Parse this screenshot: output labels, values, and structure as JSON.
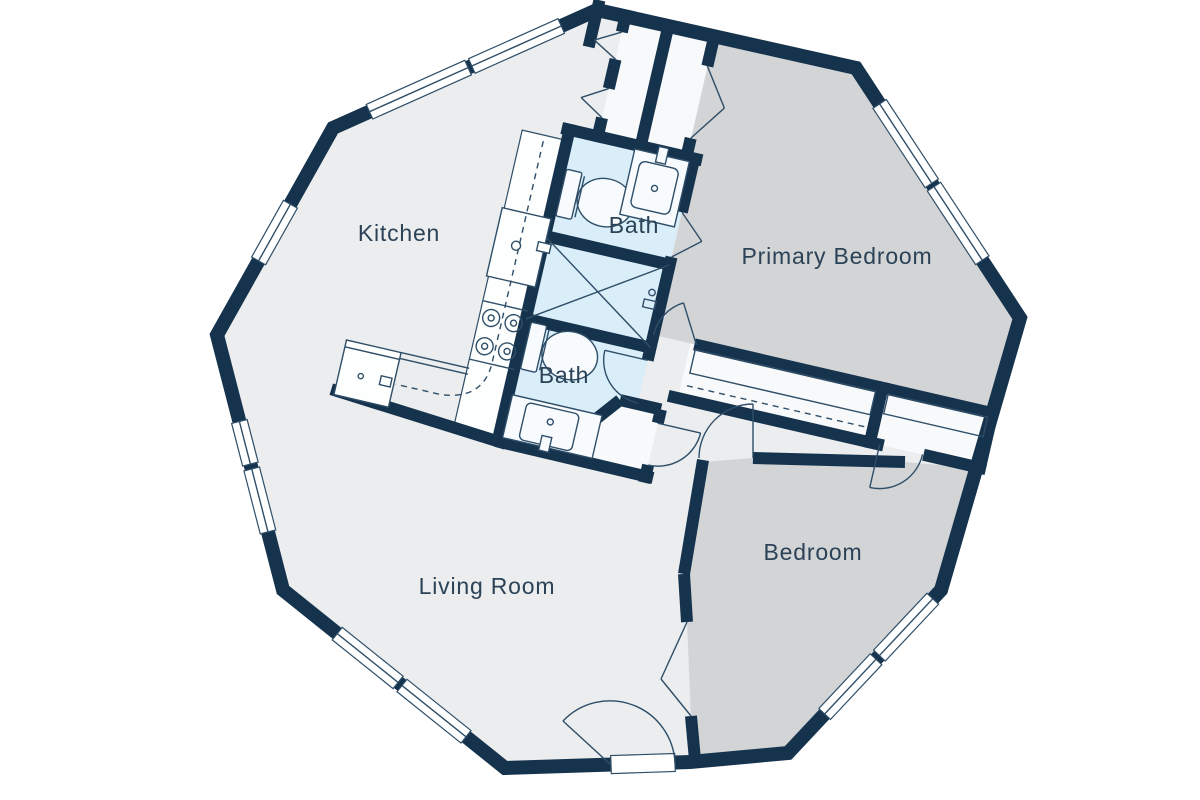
{
  "plan": {
    "type": "floor-plan",
    "shape": "decagon",
    "rooms": {
      "kitchen": {
        "label": "Kitchen"
      },
      "bath_upper": {
        "label": "Bath"
      },
      "bath_lower": {
        "label": "Bath"
      },
      "primary_bedroom": {
        "label": "Primary Bedroom"
      },
      "bedroom": {
        "label": "Bedroom"
      },
      "living_room": {
        "label": "Living Room"
      }
    },
    "colors": {
      "wall": "#16334d",
      "floor": "#ebedee",
      "bedroom_floor": "#d2d4d6",
      "bath_floor": "#d9eef9",
      "closet_floor": "#f8f9fa",
      "fixture_line": "#2f4e68",
      "label_text": "#2b4257",
      "background": "#ffffff"
    },
    "fixtures": [
      "toilet",
      "toilet",
      "vanity-sink",
      "vanity-sink",
      "kitchen-sink",
      "stove-4-burner",
      "shower",
      "wardrobe-rod",
      "appliance",
      "entry-door",
      "windows",
      "door-swings"
    ]
  }
}
